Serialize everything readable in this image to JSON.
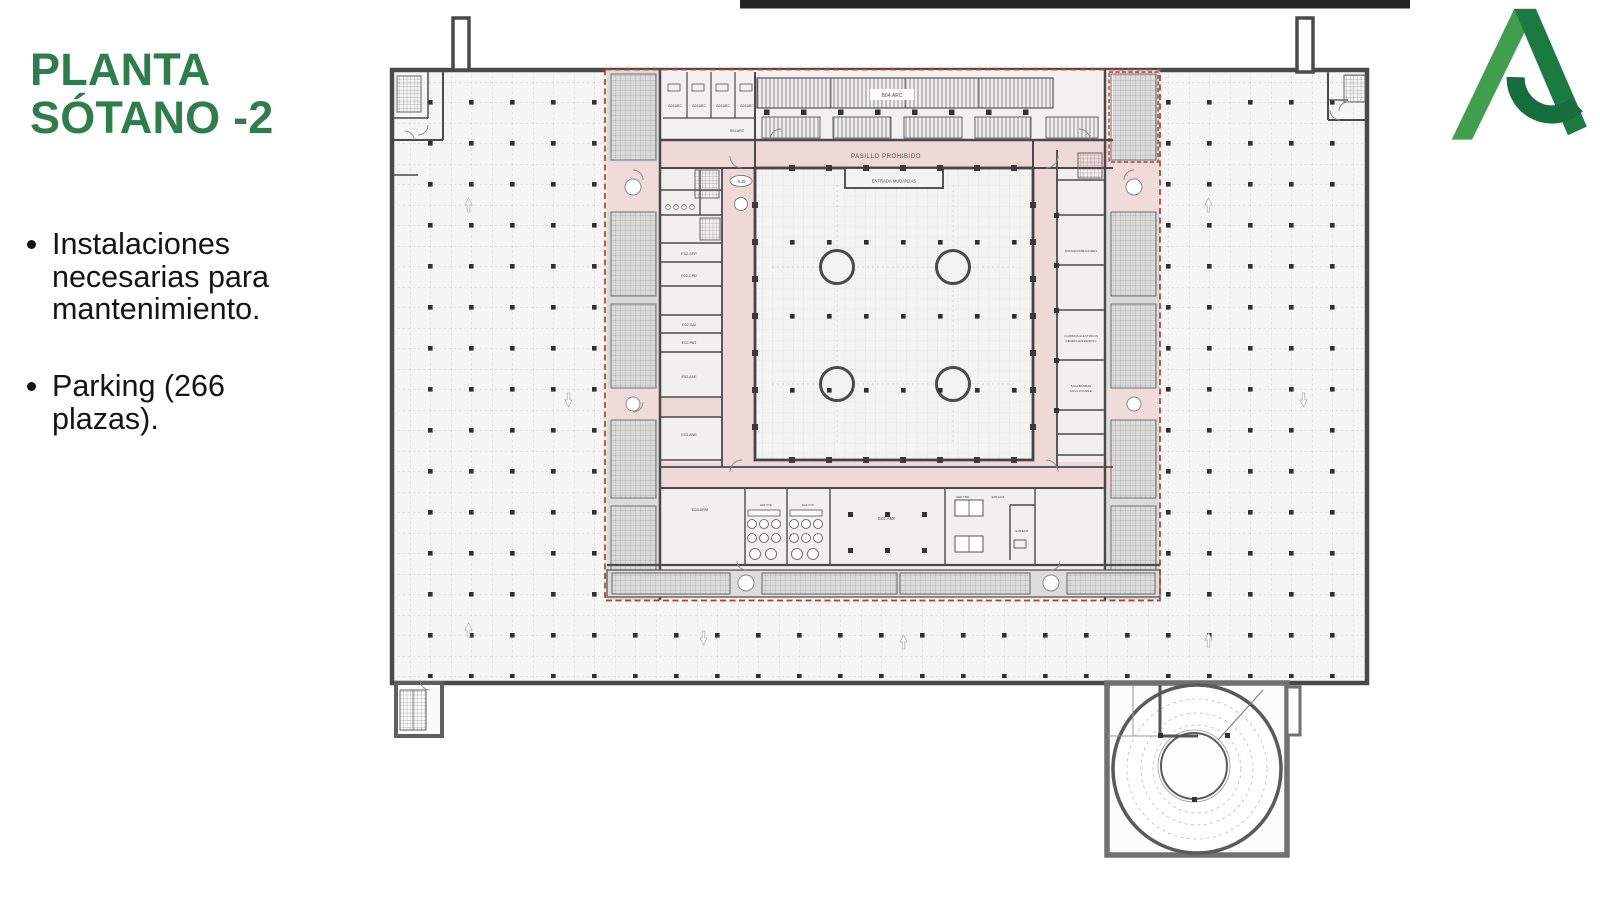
{
  "slide": {
    "title_line1": "PLANTA",
    "title_line2": "SÓTANO -2",
    "bullets": [
      "Instalaciones necesarias para mantenimiento.",
      "Parking (266 plazas)."
    ]
  },
  "logo": {
    "name": "junta-de-andalucia-a-logo"
  },
  "plan": {
    "corridor_label": "PASILLO PROHIBIDO",
    "entrance_label": "ENTRADA MUDANZAS",
    "level_marker": "-8.35",
    "archive_main": "B04.ARC",
    "archive_rooms": [
      "B04.ARC",
      "B04.ARC",
      "B04.ARC",
      "B04.ARC"
    ],
    "archive_lower": "B04.ARC",
    "left_rooms": [
      "E02.SPP",
      "E02.CPD",
      "E02.SAI",
      "E02.PAT",
      "E02.ALE",
      "E03.ANE",
      "E03.ARM"
    ],
    "right_room_transformers": "TRANSFORMADORES",
    "right_room_cuadros_1": "CUADROS ELECTRICOS",
    "right_room_cuadros_2": "GENERALES EDIFICIO",
    "right_room_bombas_1": "SALA BOMBAS",
    "right_room_bombas_2": "AGUA POTABLE",
    "bottom_rooms": [
      "E02.VTE",
      "E02.VTP",
      "E02.AMF",
      "E00.TME",
      "E00.ACS",
      "E00.EMT"
    ]
  },
  "colors": {
    "title_green": "#2E7D4C",
    "logo_green_light": "#3F9F4D",
    "logo_green_dark": "#1B7A42",
    "red_boundary": "#B23B32",
    "corridor_pink": "#EFD9D8",
    "wall_gray": "#4A4A4A"
  }
}
